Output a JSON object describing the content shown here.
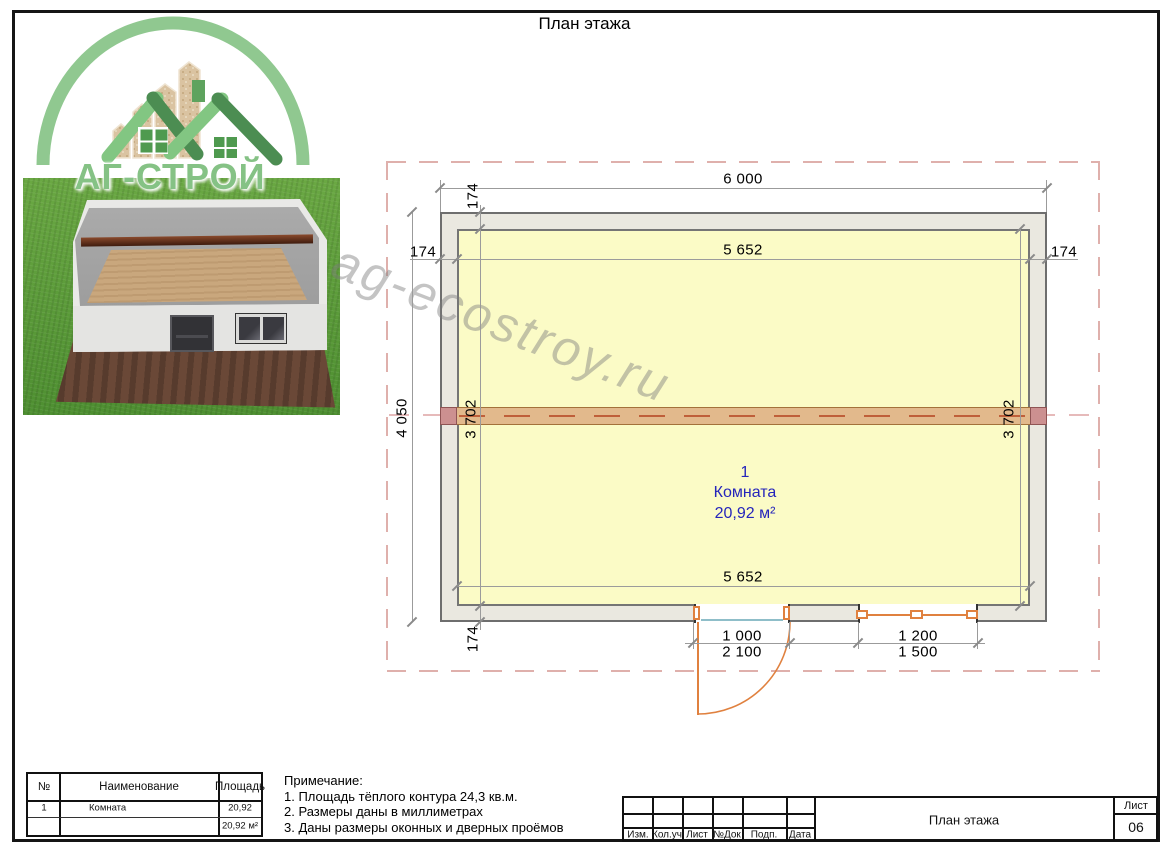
{
  "doc": {
    "title": "План этажа"
  },
  "logo": {
    "brand": "АГ-СТРОЙ"
  },
  "watermark": {
    "text": "ag-ecostroy.ru"
  },
  "plan": {
    "room_label": {
      "number": "1",
      "name": "Комната",
      "area": "20,92 м²"
    },
    "dims": {
      "overall_width": "6 000",
      "overall_height": "4 050",
      "inner_width_top": "5 652",
      "inner_width_bottom": "5 652",
      "inner_height_left": "3 702",
      "inner_height_right": "3 702",
      "wall_top": "174",
      "wall_left": "174",
      "wall_right": "174",
      "wall_bottom": "174",
      "door_width": "1 000",
      "door_height": "2 100",
      "window_width": "1 200",
      "window_height": "1 500"
    }
  },
  "rooms_table": {
    "headers": [
      "№",
      "Наименование",
      "Площадь"
    ],
    "rows": [
      {
        "num": "1",
        "name": "Комната",
        "area": "20,92"
      }
    ],
    "total": "20,92 м²"
  },
  "notes": {
    "title": "Примечание:",
    "items": [
      "1. Площадь тёплого контура 24,3 кв.м.",
      "2. Размеры даны в миллиметрах",
      "3. Даны размеры оконных и дверных проёмов"
    ]
  },
  "title_block": {
    "columns": [
      "Изм.",
      "Кол.уч",
      "Лист",
      "№Док",
      "Подп.",
      "Дата"
    ],
    "doc_name": "План этажа",
    "sheet_label": "Лист",
    "sheet_number": "06"
  }
}
